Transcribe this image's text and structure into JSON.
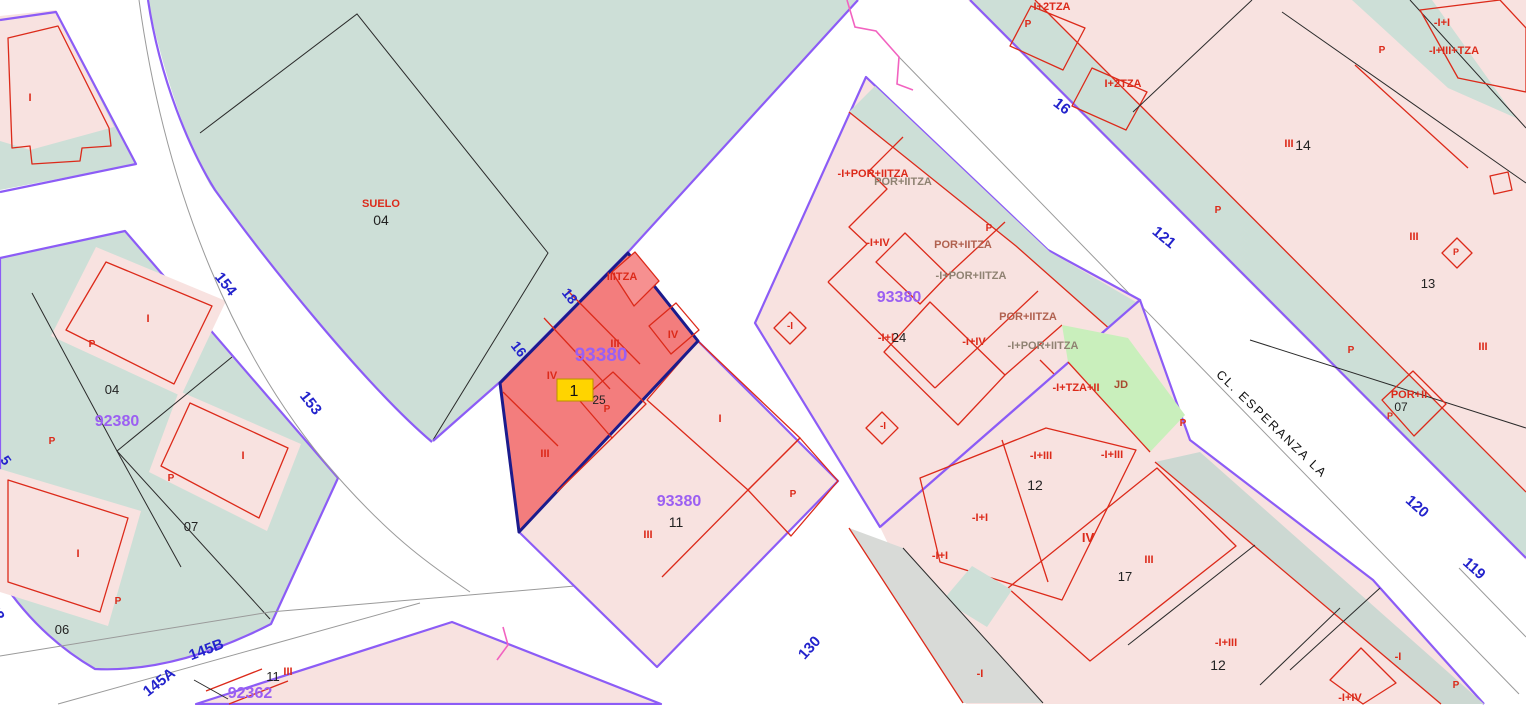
{
  "map": {
    "title": "cadastral-map-viewer",
    "selected_marker": "1",
    "selected_parcel_block": "93380",
    "street_name": "CL. ESPERANZA LA"
  },
  "colors": {
    "red": "#dc2a1a",
    "blue": "#2323cc",
    "purple": "#9b5ff2",
    "black": "#222222",
    "dim": "#8f8272",
    "rust": "#b0614f",
    "jd": "#a84a30",
    "street": "#111111"
  },
  "labels": [
    {
      "name": "street-number",
      "text": "154",
      "x": 222,
      "y": 287,
      "c": "blue",
      "s": 15,
      "r": 52,
      "b": 1
    },
    {
      "name": "street-number",
      "text": "153",
      "x": 307,
      "y": 406,
      "c": "blue",
      "s": 15,
      "r": 52,
      "b": 1
    },
    {
      "name": "street-number",
      "text": "152",
      "x": -10,
      "y": 612,
      "c": "blue",
      "s": 15,
      "r": 55,
      "b": 1
    },
    {
      "name": "street-number",
      "text": "5",
      "x": 2,
      "y": 463,
      "c": "blue",
      "s": 14,
      "r": 55,
      "b": 1
    },
    {
      "name": "street-number",
      "text": "145B",
      "x": 208,
      "y": 654,
      "c": "blue",
      "s": 15,
      "r": -21,
      "b": 1
    },
    {
      "name": "street-number",
      "text": "145A",
      "x": 162,
      "y": 686,
      "c": "blue",
      "s": 15,
      "r": -38,
      "b": 1
    },
    {
      "name": "edge-length",
      "text": "18",
      "x": 566,
      "y": 299,
      "c": "blue",
      "s": 14,
      "r": 52,
      "b": 1
    },
    {
      "name": "edge-length",
      "text": "16",
      "x": 515,
      "y": 352,
      "c": "blue",
      "s": 14,
      "r": 52,
      "b": 1
    },
    {
      "name": "street-number",
      "text": "16",
      "x": 1059,
      "y": 110,
      "c": "blue",
      "s": 15,
      "r": 38,
      "b": 1
    },
    {
      "name": "street-number",
      "text": "121",
      "x": 1161,
      "y": 241,
      "c": "blue",
      "s": 15,
      "r": 40,
      "b": 1
    },
    {
      "name": "street-number",
      "text": "120",
      "x": 1414,
      "y": 510,
      "c": "blue",
      "s": 15,
      "r": 42,
      "b": 1
    },
    {
      "name": "street-number",
      "text": "119",
      "x": 1471,
      "y": 572,
      "c": "blue",
      "s": 15,
      "r": 42,
      "b": 1
    },
    {
      "name": "street-number",
      "text": "130",
      "x": 813,
      "y": 651,
      "c": "blue",
      "s": 15,
      "r": -48,
      "b": 1
    },
    {
      "name": "block-id-selected",
      "text": "93380",
      "x": 601,
      "y": 361,
      "c": "purple",
      "s": 19,
      "b": 1
    },
    {
      "name": "block-id",
      "text": "93380",
      "x": 899,
      "y": 302,
      "c": "purple",
      "s": 16,
      "b": 1
    },
    {
      "name": "block-id",
      "text": "93380",
      "x": 679,
      "y": 506,
      "c": "purple",
      "s": 16,
      "b": 1
    },
    {
      "name": "block-id",
      "text": "92380",
      "x": 117,
      "y": 426,
      "c": "purple",
      "s": 16,
      "b": 1
    },
    {
      "name": "block-id",
      "text": "92362",
      "x": 250,
      "y": 698,
      "c": "purple",
      "s": 16,
      "b": 1
    },
    {
      "name": "parcel-number",
      "text": "04",
      "x": 381,
      "y": 225,
      "c": "black",
      "s": 14
    },
    {
      "name": "parcel-number",
      "text": "04",
      "x": 112,
      "y": 394,
      "c": "black",
      "s": 13
    },
    {
      "name": "parcel-number",
      "text": "07",
      "x": 191,
      "y": 531,
      "c": "black",
      "s": 13
    },
    {
      "name": "parcel-number",
      "text": "06",
      "x": 62,
      "y": 634,
      "c": "black",
      "s": 13
    },
    {
      "name": "parcel-number",
      "text": "11",
      "x": 676,
      "y": 527,
      "c": "black",
      "s": 14
    },
    {
      "name": "parcel-number",
      "text": "11",
      "x": 273,
      "y": 681,
      "c": "black",
      "s": 13
    },
    {
      "name": "parcel-number",
      "text": "14",
      "x": 1303,
      "y": 150,
      "c": "black",
      "s": 14
    },
    {
      "name": "parcel-number",
      "text": "13",
      "x": 1428,
      "y": 288,
      "c": "black",
      "s": 13
    },
    {
      "name": "parcel-number",
      "text": "24",
      "x": 899,
      "y": 342,
      "c": "black",
      "s": 13
    },
    {
      "name": "parcel-number",
      "text": "12",
      "x": 1035,
      "y": 490,
      "c": "black",
      "s": 14
    },
    {
      "name": "parcel-number",
      "text": "17",
      "x": 1125,
      "y": 581,
      "c": "black",
      "s": 13
    },
    {
      "name": "parcel-number",
      "text": "12",
      "x": 1218,
      "y": 670,
      "c": "black",
      "s": 14
    },
    {
      "name": "parcel-number",
      "text": "07",
      "x": 1401,
      "y": 411,
      "c": "black",
      "s": 12
    },
    {
      "name": "parcel-number",
      "text": "25",
      "x": 599,
      "y": 404,
      "c": "black",
      "s": 12
    },
    {
      "name": "street-name",
      "text": "CL. ESPERANZA LA",
      "x": 1269,
      "y": 427,
      "c": "street",
      "s": 12.5,
      "r": 44,
      "ls": 2
    },
    {
      "name": "land-label",
      "text": "SUELO",
      "x": 381,
      "y": 207,
      "c": "red",
      "s": 11,
      "b": 1
    },
    {
      "name": "floors-label",
      "text": "I",
      "x": 30,
      "y": 101,
      "c": "red",
      "b": 1
    },
    {
      "name": "floors-label",
      "text": "I",
      "x": 148,
      "y": 322,
      "c": "red",
      "b": 1
    },
    {
      "name": "floors-label",
      "text": "I",
      "x": 243,
      "y": 459,
      "c": "red",
      "b": 1
    },
    {
      "name": "floors-label",
      "text": "I",
      "x": 78,
      "y": 557,
      "c": "red",
      "b": 1
    },
    {
      "name": "patio-label",
      "text": "P",
      "x": 92,
      "y": 347,
      "c": "red",
      "s": 10,
      "b": 1
    },
    {
      "name": "patio-label",
      "text": "P",
      "x": 52,
      "y": 444,
      "c": "red",
      "s": 10,
      "b": 1
    },
    {
      "name": "patio-label",
      "text": "P",
      "x": 171,
      "y": 481,
      "c": "red",
      "s": 10,
      "b": 1
    },
    {
      "name": "patio-label",
      "text": "P",
      "x": 118,
      "y": 604,
      "c": "red",
      "s": 10,
      "b": 1
    },
    {
      "name": "floors-label",
      "text": "I",
      "x": 720,
      "y": 422,
      "c": "red",
      "b": 1
    },
    {
      "name": "patio-label",
      "text": "P",
      "x": 793,
      "y": 497,
      "c": "red",
      "s": 10,
      "b": 1
    },
    {
      "name": "floors-label",
      "text": "III",
      "x": 648,
      "y": 538,
      "c": "red",
      "b": 1
    },
    {
      "name": "floors-label",
      "text": "III",
      "x": 288,
      "y": 675,
      "c": "red",
      "b": 1
    },
    {
      "name": "floors-label",
      "text": "IIITZA",
      "x": 622,
      "y": 280,
      "c": "red",
      "b": 1
    },
    {
      "name": "floors-label",
      "text": "III",
      "x": 615,
      "y": 347,
      "c": "red",
      "b": 1
    },
    {
      "name": "floors-label",
      "text": "IV",
      "x": 673,
      "y": 338,
      "c": "red",
      "b": 1
    },
    {
      "name": "floors-label",
      "text": "IV",
      "x": 552,
      "y": 379,
      "c": "red",
      "b": 1
    },
    {
      "name": "patio-label",
      "text": "P",
      "x": 607,
      "y": 412,
      "c": "red",
      "s": 10,
      "b": 1
    },
    {
      "name": "floors-label",
      "text": "III",
      "x": 545,
      "y": 457,
      "c": "red",
      "b": 1
    },
    {
      "name": "floors-label",
      "text": "-I+POR+IITZA",
      "x": 873,
      "y": 177,
      "c": "red",
      "b": 1
    },
    {
      "name": "floors-label",
      "text": "POR+IITZA",
      "x": 903,
      "y": 185,
      "c": "dim",
      "b": 1
    },
    {
      "name": "floors-label",
      "text": "-I+IV",
      "x": 878,
      "y": 246,
      "c": "red",
      "b": 1
    },
    {
      "name": "floors-label",
      "text": "POR+IITZA",
      "x": 963,
      "y": 248,
      "c": "rust",
      "b": 1
    },
    {
      "name": "floors-label",
      "text": "-I+POR+IITZA",
      "x": 971,
      "y": 279,
      "c": "dim",
      "b": 1
    },
    {
      "name": "patio-label",
      "text": "P",
      "x": 989,
      "y": 231,
      "c": "red",
      "s": 10,
      "b": 1
    },
    {
      "name": "floors-label",
      "text": "-I+I",
      "x": 886,
      "y": 341,
      "c": "red",
      "b": 1
    },
    {
      "name": "floors-label",
      "text": "-I+IV",
      "x": 974,
      "y": 345,
      "c": "red",
      "b": 1
    },
    {
      "name": "floors-label",
      "text": "POR+IITZA",
      "x": 1028,
      "y": 320,
      "c": "rust",
      "b": 1
    },
    {
      "name": "floors-label",
      "text": "-I+POR+IITZA",
      "x": 1043,
      "y": 349,
      "c": "dim",
      "b": 1
    },
    {
      "name": "floors-label",
      "text": "-I+TZA+II",
      "x": 1076,
      "y": 391,
      "c": "red",
      "b": 1
    },
    {
      "name": "garden-label",
      "text": "JD",
      "x": 1121,
      "y": 388,
      "c": "jd",
      "s": 11,
      "b": 1
    },
    {
      "name": "patio-label",
      "text": "P",
      "x": 1183,
      "y": 426,
      "c": "red",
      "s": 10,
      "b": 1
    },
    {
      "name": "floors-label",
      "text": "I+2TZA",
      "x": 1052,
      "y": 10,
      "c": "red",
      "b": 1
    },
    {
      "name": "patio-label",
      "text": "P",
      "x": 1028,
      "y": 27,
      "c": "red",
      "s": 10,
      "b": 1
    },
    {
      "name": "floors-label",
      "text": "I+2TZA",
      "x": 1123,
      "y": 87,
      "c": "red",
      "b": 1
    },
    {
      "name": "floors-label",
      "text": "-I+I",
      "x": 1442,
      "y": 26,
      "c": "red",
      "b": 1
    },
    {
      "name": "floors-label",
      "text": "-I+III+TZA",
      "x": 1454,
      "y": 54,
      "c": "red",
      "b": 1
    },
    {
      "name": "patio-label",
      "text": "P",
      "x": 1382,
      "y": 53,
      "c": "red",
      "s": 10,
      "b": 1
    },
    {
      "name": "floors-label",
      "text": "III",
      "x": 1289,
      "y": 147,
      "c": "red",
      "b": 1
    },
    {
      "name": "patio-label",
      "text": "P",
      "x": 1218,
      "y": 213,
      "c": "red",
      "s": 10,
      "b": 1
    },
    {
      "name": "floors-label",
      "text": "III",
      "x": 1414,
      "y": 240,
      "c": "red",
      "b": 1
    },
    {
      "name": "patio-label",
      "text": "P",
      "x": 1456,
      "y": 255,
      "c": "red",
      "s": 9,
      "b": 1
    },
    {
      "name": "floors-label",
      "text": "III",
      "x": 1483,
      "y": 350,
      "c": "red",
      "b": 1
    },
    {
      "name": "patio-label",
      "text": "P",
      "x": 1351,
      "y": 353,
      "c": "red",
      "s": 10,
      "b": 1
    },
    {
      "name": "floors-label",
      "text": "POR+II",
      "x": 1409,
      "y": 398,
      "c": "red",
      "b": 1
    },
    {
      "name": "patio-label",
      "text": "P",
      "x": 1390,
      "y": 419,
      "c": "red",
      "s": 9,
      "b": 1
    },
    {
      "name": "floors-label",
      "text": "-I+III",
      "x": 1041,
      "y": 459,
      "c": "red",
      "b": 1
    },
    {
      "name": "floors-label",
      "text": "-I+III",
      "x": 1112,
      "y": 458,
      "c": "red",
      "b": 1
    },
    {
      "name": "floors-label",
      "text": "-I+I",
      "x": 980,
      "y": 521,
      "c": "red",
      "b": 1
    },
    {
      "name": "floors-label",
      "text": "-I+I",
      "x": 940,
      "y": 559,
      "c": "red",
      "b": 1
    },
    {
      "name": "floors-label",
      "text": "IV",
      "x": 1088,
      "y": 542,
      "c": "red",
      "s": 13,
      "b": 1
    },
    {
      "name": "floors-label",
      "text": "III",
      "x": 1149,
      "y": 563,
      "c": "red",
      "b": 1
    },
    {
      "name": "floors-label",
      "text": "-I",
      "x": 980,
      "y": 677,
      "c": "red",
      "b": 1
    },
    {
      "name": "floors-label",
      "text": "-I+III",
      "x": 1226,
      "y": 646,
      "c": "red",
      "b": 1
    },
    {
      "name": "floors-label",
      "text": "-I",
      "x": 1398,
      "y": 660,
      "c": "red",
      "b": 1
    },
    {
      "name": "floors-label",
      "text": "-I+IV",
      "x": 1350,
      "y": 701,
      "c": "red",
      "b": 1
    },
    {
      "name": "patio-label",
      "text": "P",
      "x": 1456,
      "y": 688,
      "c": "red",
      "s": 10,
      "b": 1
    },
    {
      "name": "floors-label",
      "text": "-I",
      "x": 790,
      "y": 329,
      "c": "red",
      "s": 10,
      "b": 1
    },
    {
      "name": "floors-label",
      "text": "-I",
      "x": 883,
      "y": 429,
      "c": "red",
      "s": 10,
      "b": 1
    }
  ]
}
